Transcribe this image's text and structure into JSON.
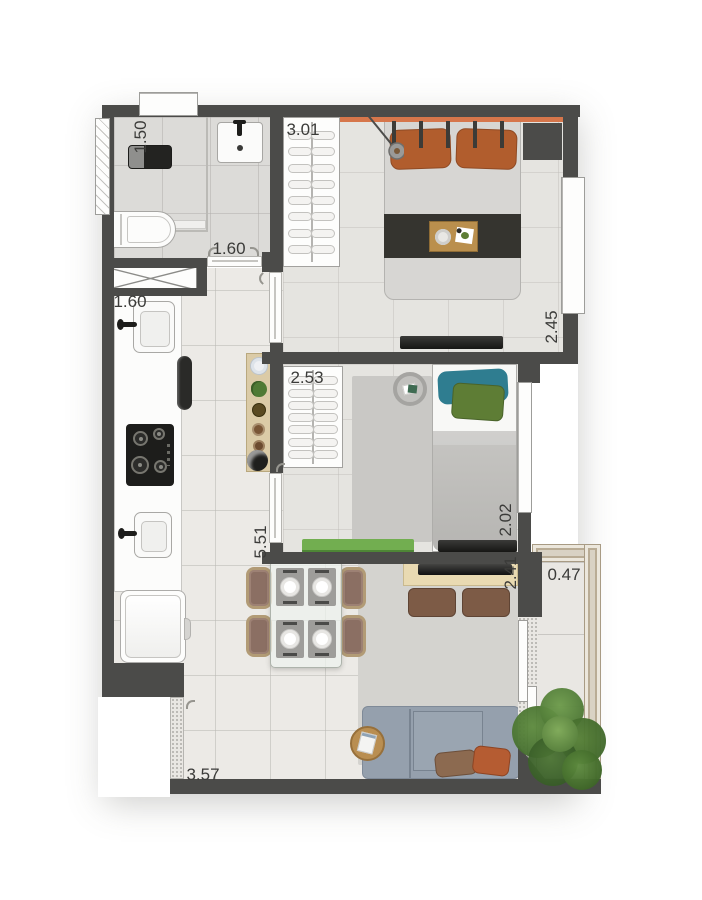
{
  "title": "Apartment floor plan",
  "dims": {
    "bathroom_width": "1.50",
    "bedroom1_wardrobe": "3.01",
    "bathroom_door": "1.60",
    "bedroom1_depth": "2.45",
    "kitchen_width": "1.60",
    "bedroom2_wardrobe": "2.53",
    "bedroom2_depth": "2.02",
    "kitchen_length": "5.51",
    "tv_wall": "2.41",
    "balcony_width": "0.47",
    "living_length": "3.57",
    "balcony_length": "2.32"
  },
  "colors": {
    "wall": "#4b4b49",
    "dimtext": "#3b3b39",
    "accent": "#d6764b",
    "orange": "#b15d2d",
    "duvet": "#d7d6d3",
    "throw": "#35342f",
    "teal": "#2f7d90",
    "greenpillow": "#5e7d35",
    "bench": "#72ae50",
    "sofa": "#95a0ad",
    "poufbrown": "#7d5b46",
    "wood": "#e9dab2",
    "plant": "#4c7434"
  }
}
